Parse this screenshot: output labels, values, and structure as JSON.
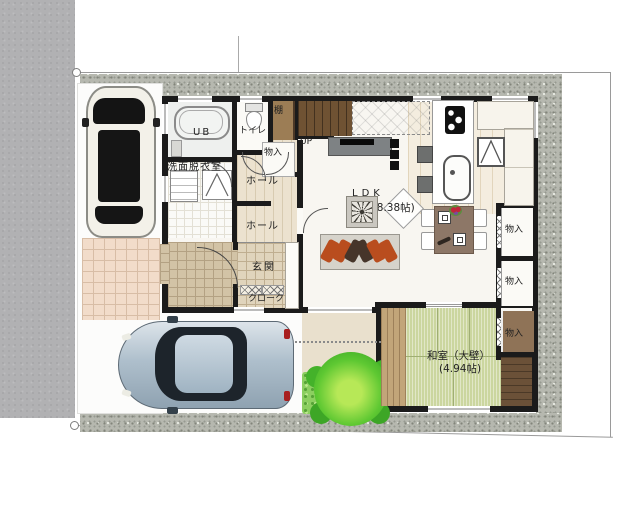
{
  "plan": {
    "rooms": {
      "ub": "UB",
      "toilet": "トイレ",
      "shelf": "棚",
      "stairs_up": "UP",
      "storage_stair": "物入",
      "hall_upper": "ホール",
      "hall_lower": "ホール",
      "washroom": "洗面脱衣室",
      "entrance": "玄関",
      "cloak": "クローク",
      "ldk_label": "LDK",
      "ldk_area": "(18.38帖)",
      "storage_right_upper": "物入",
      "storage_right_middle": "物入",
      "storage_washitsu": "物入",
      "washitsu_label": "和室（大壁）",
      "washitsu_area": "(4.94帖)"
    },
    "colors": {
      "wall": "#1b1b1b",
      "concrete_band": "#b6b8af",
      "tatami_green": "#cbd69f",
      "sofa_orange": "#b94d1e",
      "sofa_brown": "#46352a",
      "tree_green": "#4cb52e",
      "approach_tile": "#f2dcca"
    }
  }
}
